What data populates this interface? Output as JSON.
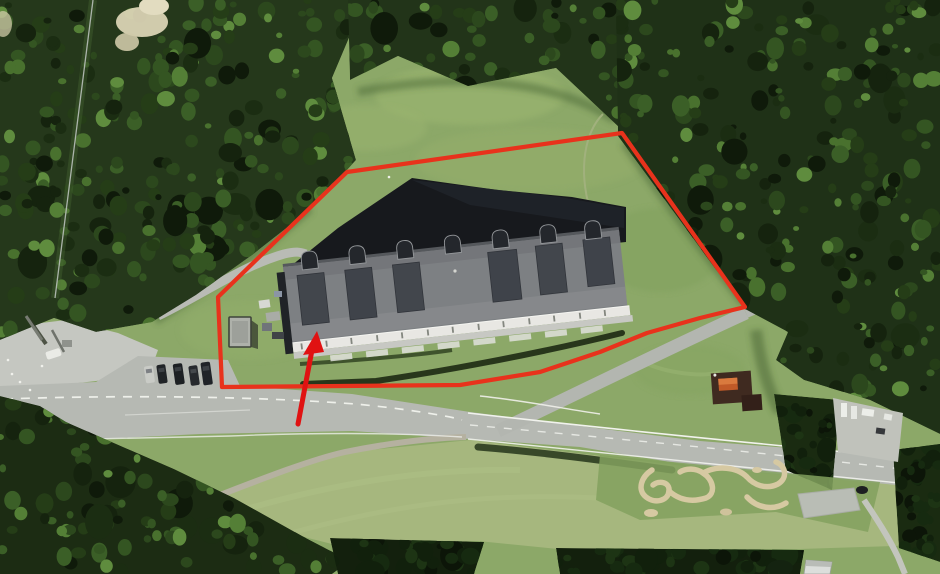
{
  "view": {
    "kind": "satellite-aerial-photo",
    "width": 940,
    "height": 574
  },
  "annotation": {
    "outline_color": "#e8321c",
    "arrow_color": "#e01212",
    "polygon_points": "347,172 622,133 745,307 700,318 647,333 600,352 540,372 460,385 222,387 218,297",
    "arrow_shaft_points": "298,424 312,350",
    "arrow_head_points": "317,331 303,355 324,352"
  },
  "features": {
    "parcel_outline": "red-parcel-outline",
    "arrow": "red-location-arrow",
    "building": "large-hall-building",
    "shed": "small-shed",
    "hut": "brown-hut",
    "forest": "forest",
    "clearing": "grass-clearing",
    "meadow": "meadow",
    "main_road": "main-road",
    "branch_road": "branch-road",
    "path": "field-path",
    "parking": "parked-cars",
    "cableway": "cableway-line",
    "pump_track": "pump-track",
    "campers": "parked-campers"
  },
  "palette": {
    "grass": "#8ca868",
    "meadow": "#a6b77e",
    "forest_dark": "#15230e",
    "forest_mid": "#2c481d",
    "road": "#b6b9b3",
    "roof_gray": "#7d8083",
    "roof_shadow": "#17191d",
    "facade_white": "#e8e7e3",
    "hut_roof": "#3f2a20",
    "track_tan": "#d6c9a2"
  }
}
